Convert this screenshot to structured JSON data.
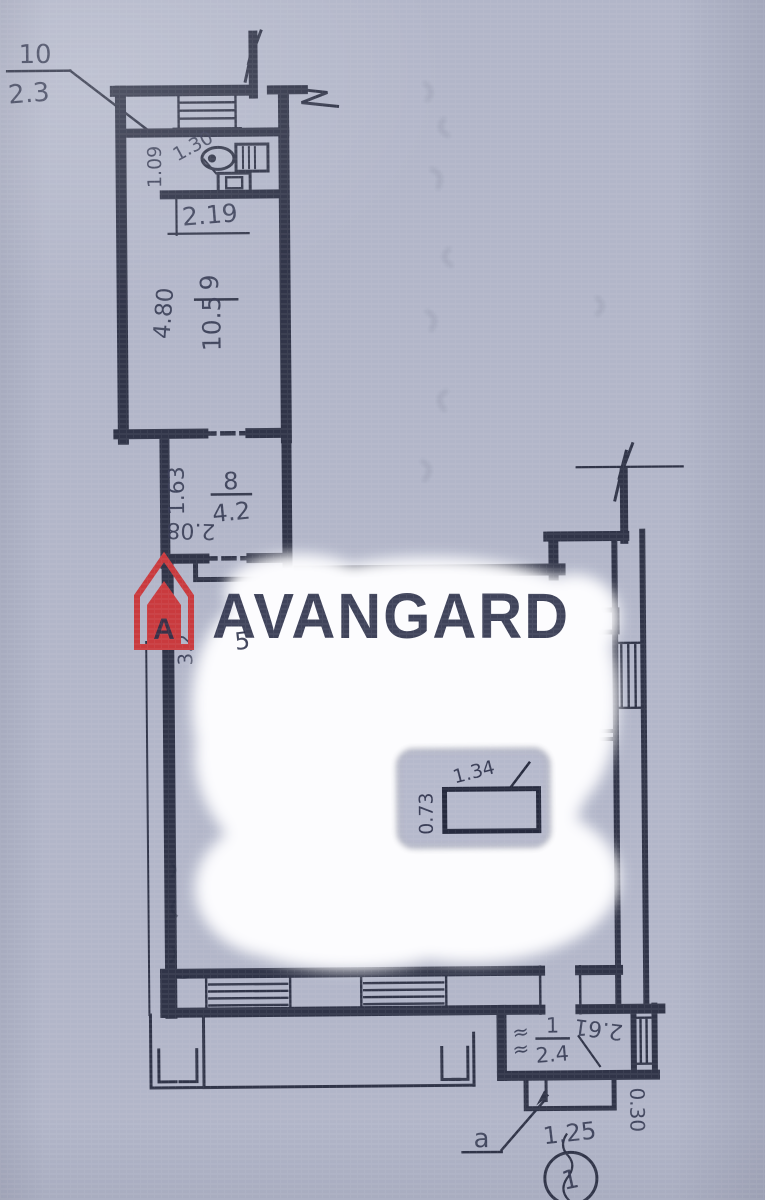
{
  "logo": {
    "brand": "AVANGARD"
  },
  "unit_callout": {
    "number": "10",
    "area": "2.3"
  },
  "wc_room": {
    "dim_diag": "1.30",
    "dim_side": "1.09",
    "dim_width": "2.19"
  },
  "room9": {
    "length": "4.80",
    "number": "9",
    "area": "10.5"
  },
  "room8": {
    "dim_side": "1.63",
    "dim_bottom": "2.08",
    "number": "8",
    "area": "4.2"
  },
  "hall": {
    "number": "5",
    "dim_side": "3.2"
  },
  "duct": {
    "dim_w": "0.73",
    "dim_diag": "1.34"
  },
  "vestibule": {
    "number": "1",
    "area": "2.4",
    "approx_mark": "≈",
    "dim_diag": "2.61",
    "dim_step": "0.30"
  },
  "porch": {
    "letter": "a",
    "dim": "1.25"
  },
  "axis_marker": {
    "number": "1"
  },
  "colors": {
    "paper": "#b2b6c9",
    "ink": "#262a3e",
    "logo_red": "#c93a3e",
    "logo_gray": "#6e7380",
    "erase_white": "#fcfcfe"
  }
}
